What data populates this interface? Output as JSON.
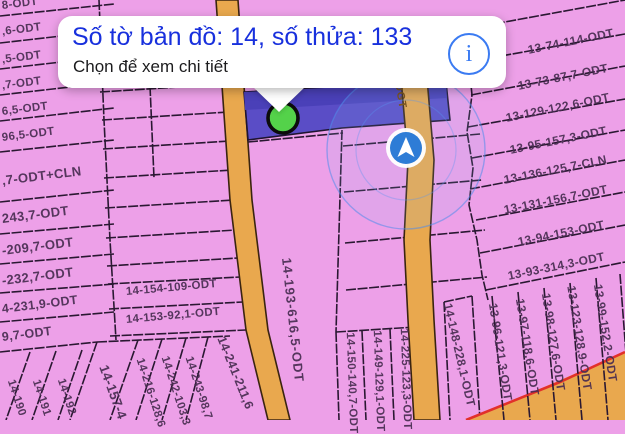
{
  "popup": {
    "title": "Số tờ bản đồ: 14, số thửa: 133",
    "subtitle": "Chọn để xem chi tiết",
    "info_icon": "i"
  },
  "road": {
    "label": "DGT"
  },
  "labels": {
    "left": [
      "8-ODT",
      ",6-ODT",
      ",5-ODT",
      ",7-ODT",
      "6,5-ODT",
      "96,5-ODT",
      ",7-ODT+CLN",
      "243,7-ODT",
      "-209,7-ODT",
      "-232,7-ODT",
      "4-231,9-ODT",
      "9,7-ODT"
    ],
    "mid": [
      "14-154-109-ODT",
      "14-153-92,1-ODT"
    ],
    "center": "14-193-616,5-ODT",
    "right": [
      "13-74-114-ODT",
      "13-73-87,7-ODT",
      "13-129-122,6-ODT",
      "13-95-157,3-ODT",
      "13-136-125,7-CLN",
      "13-131-156,7-ODT",
      "13-94-153-ODT",
      "13-93-314,3-ODT"
    ],
    "bottom_mid": [
      "14-150-140,7-ODT",
      "14-149-129,1-ODT",
      "14-225-123,3-ODT",
      "14-148-228,1-ODT"
    ],
    "bottom_left": [
      "14-190",
      "14-191",
      "14-192",
      "14-157-4",
      "14-216-128,6",
      "14-242-103,3",
      "14-243-98,7",
      "14-241-211,6"
    ],
    "bottom_right": [
      "13-96-121,3-ODT",
      "13-97-118,6-ODT",
      "13-98-127,6-ODT",
      "13-123-128,9-ODT",
      "13-99-152,2-ODT"
    ]
  },
  "colors": {
    "parcel_pink": "#eda0e8",
    "selected_parcel_purple": "#5a4dc6",
    "road_orange": "#e9a84e",
    "boundary_red": "#e2302a",
    "popup_title_blue": "#1830dd",
    "info_blue": "#3b7bf2",
    "compass_blue": "#2e7cd6",
    "marker_green": "#54d24a"
  }
}
